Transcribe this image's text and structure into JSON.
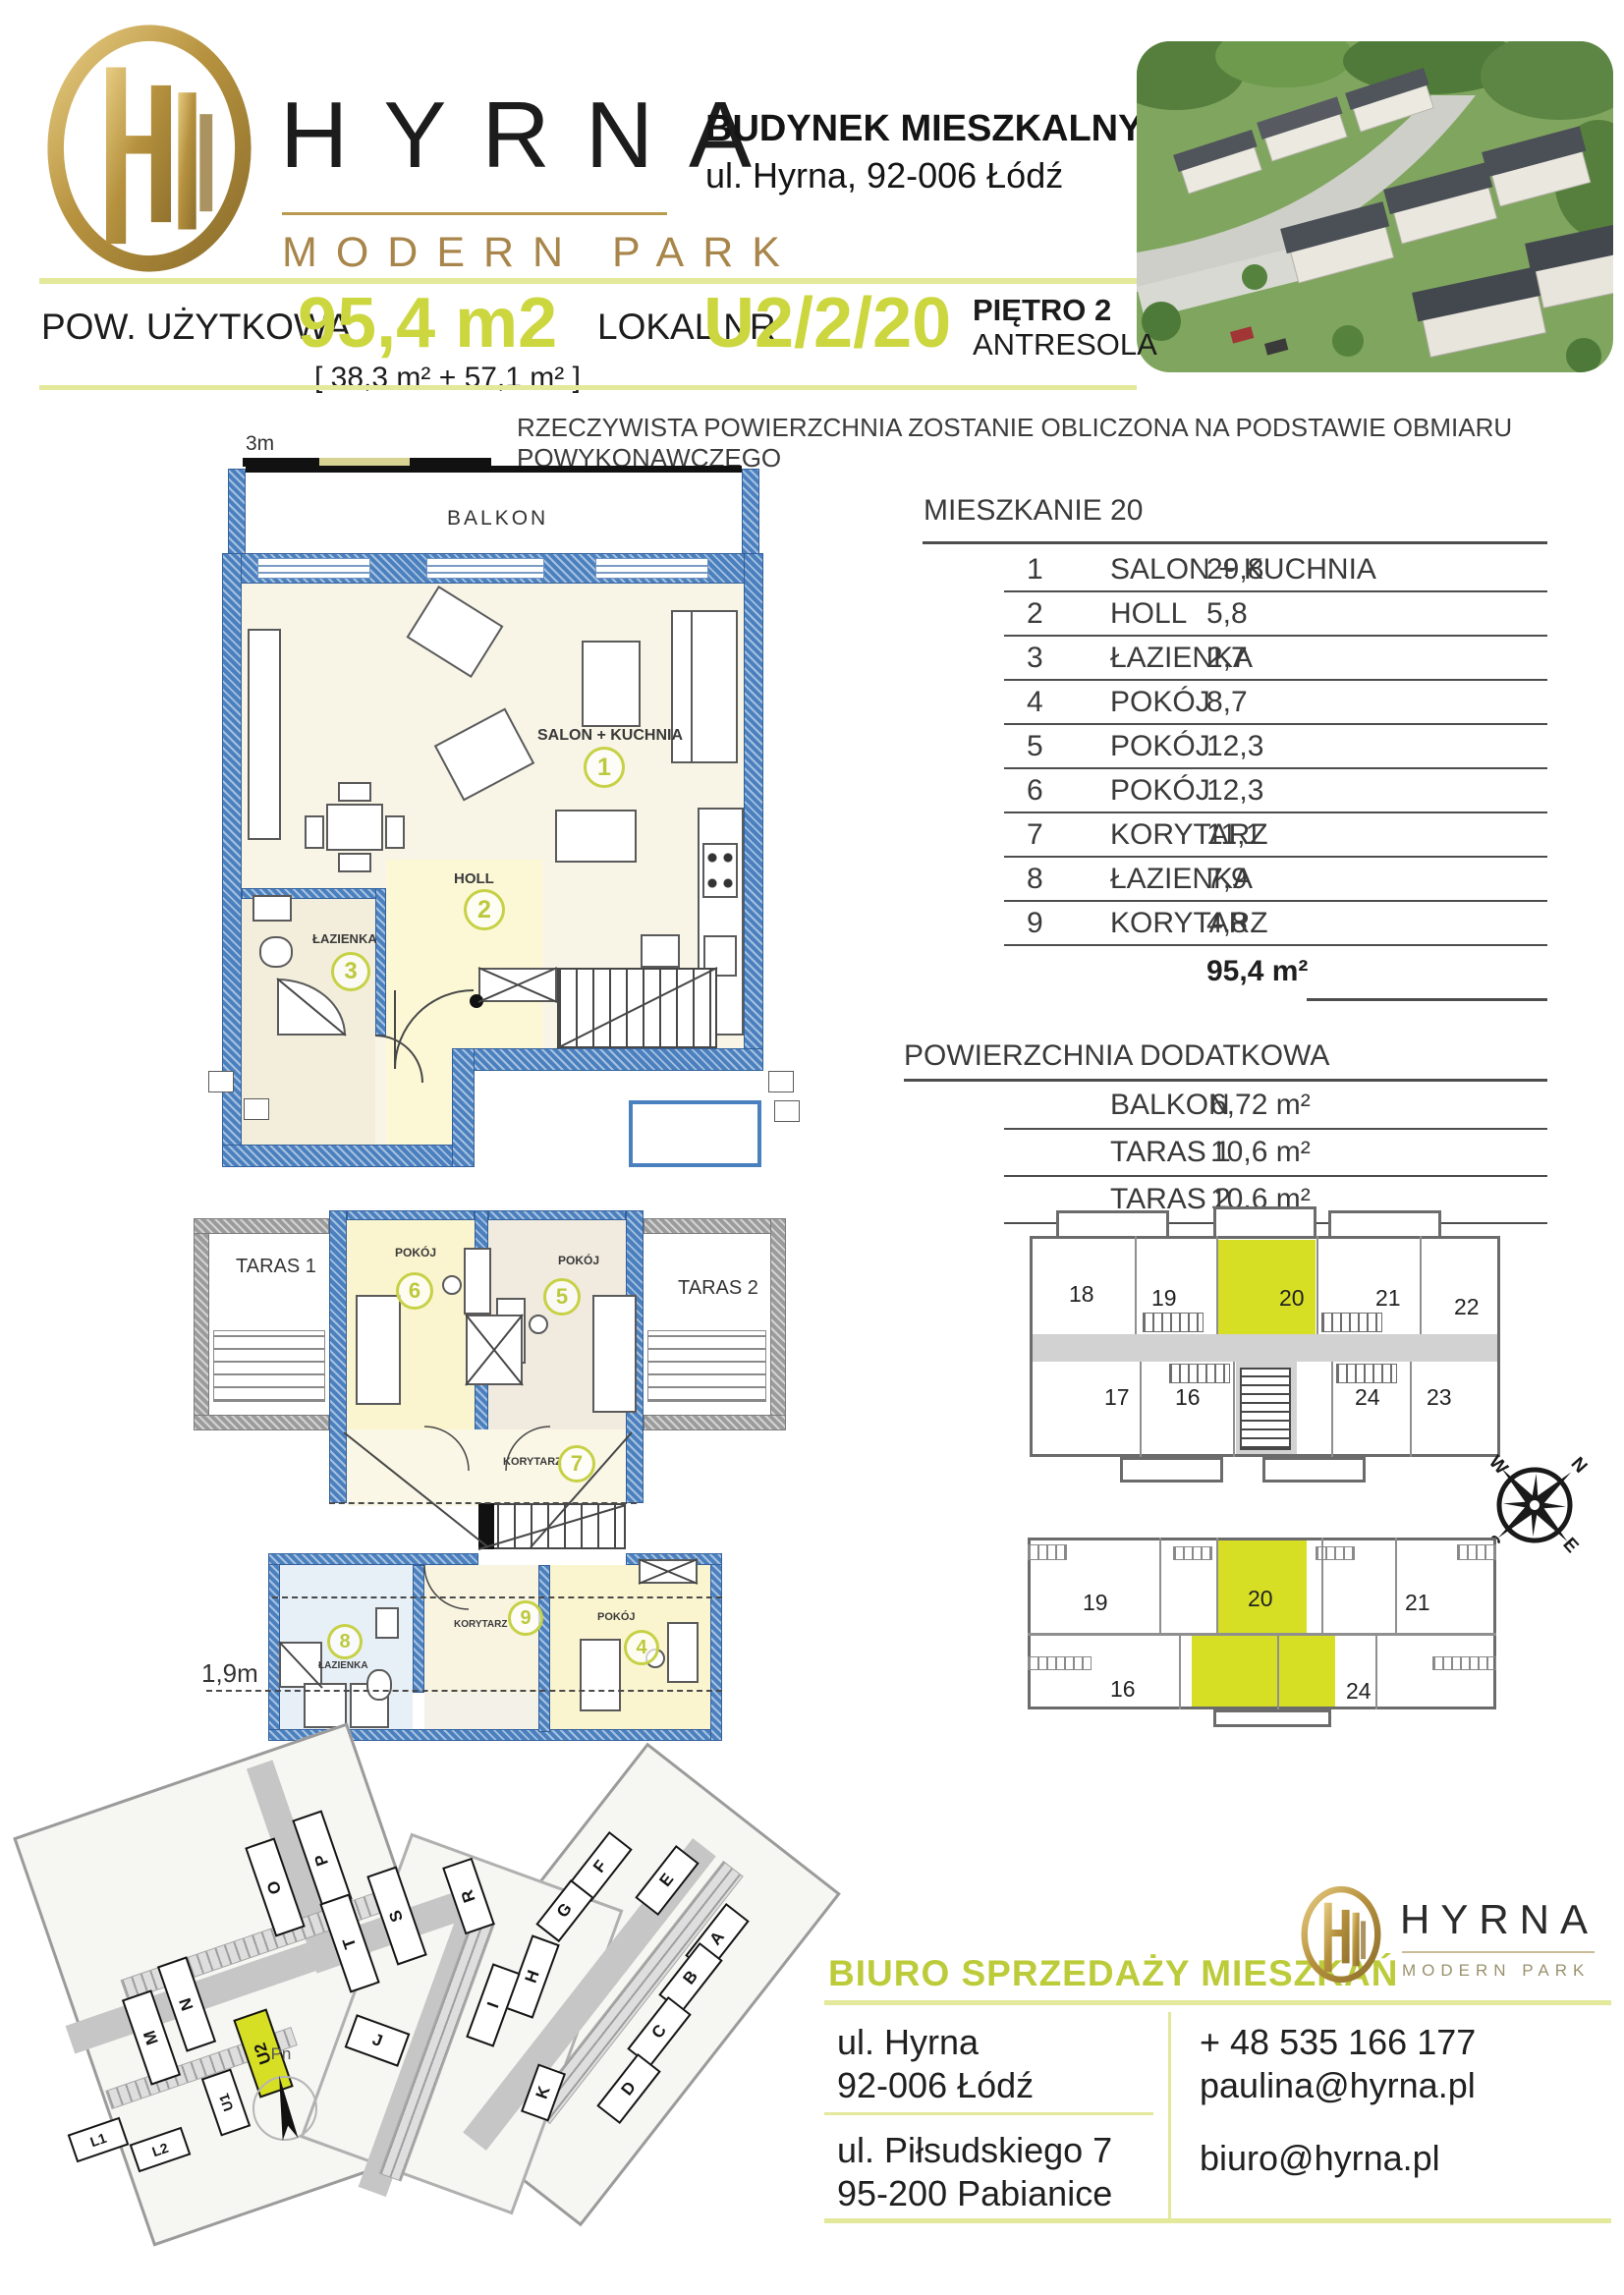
{
  "brand": {
    "name": "HYRNA",
    "tagline": "MODERN PARK"
  },
  "header": {
    "building_title": "BUDYNEK MIESZKALNY U2",
    "building_address": "ul. Hyrna, 92-006 Łódź"
  },
  "info": {
    "area_label": "POW. UŻYTKOWA",
    "area_value": "95,4 m2",
    "area_split": "[ 38,3 m² + 57,1 m² ]",
    "unit_label": "LOKAL NR",
    "unit_value": "U2/2/20",
    "floor_line1": "PIĘTRO 2",
    "floor_line2": "ANTRESOLA"
  },
  "disclaimer": "RZECZYWISTA POWIERZCHNIA ZOSTANIE OBLICZONA NA PODSTAWIE OBMIARU POWYKONAWCZEGO",
  "scalebar": {
    "label": "3m"
  },
  "apt": {
    "title": "MIESZKANIE 20",
    "rows": [
      {
        "no": "1",
        "name": "SALON + KUCHNIA",
        "area": "29,8"
      },
      {
        "no": "2",
        "name": "HOLL",
        "area": "5,8"
      },
      {
        "no": "3",
        "name": "ŁAZIENKA",
        "area": "2,7"
      },
      {
        "no": "4",
        "name": "POKÓJ",
        "area": "8,7"
      },
      {
        "no": "5",
        "name": "POKÓJ",
        "area": "12,3"
      },
      {
        "no": "6",
        "name": "POKÓJ",
        "area": "12,3"
      },
      {
        "no": "7",
        "name": "KORYTARZ",
        "area": "11,1"
      },
      {
        "no": "8",
        "name": "ŁAZIENKA",
        "area": "7,9"
      },
      {
        "no": "9",
        "name": "KORYTARZ",
        "area": "4,8"
      }
    ],
    "total": "95,4 m²"
  },
  "extra": {
    "title": "POWIERZCHNIA DODATKOWA",
    "rows": [
      {
        "name": "BALKON",
        "area": "6,72 m²"
      },
      {
        "name": "TARAS 1",
        "area": "10,6 m²"
      },
      {
        "name": "TARAS 2",
        "area": "10,6 m²"
      }
    ]
  },
  "plan_upper": {
    "balkon": "BALKON",
    "salon": "SALON + KUCHNIA",
    "salon_no": "1",
    "holl": "HOLL",
    "holl_no": "2",
    "lazienka": "ŁAZIENKA",
    "lazienka_no": "3"
  },
  "plan_lower": {
    "taras1": "TARAS 1",
    "taras2": "TARAS 2",
    "pokoj6": "POKÓJ",
    "pokoj6_no": "6",
    "pokoj5": "POKÓJ",
    "pokoj5_no": "5",
    "korytarz7": "KORYTARZ",
    "korytarz7_no": "7",
    "lazienka8": "ŁAZIENKA",
    "lazienka8_no": "8",
    "korytarz9": "KORYTARZ",
    "korytarz9_no": "9",
    "pokoj4": "POKÓJ",
    "pokoj4_no": "4",
    "height_line": "1,9m"
  },
  "overview_floor": {
    "units": [
      "18",
      "19",
      "20",
      "21",
      "22",
      "17",
      "16",
      "24",
      "23"
    ],
    "highlighted": "20"
  },
  "overview_antresola": {
    "units": [
      "19",
      "20",
      "21",
      "16",
      "24"
    ],
    "highlighted": "20"
  },
  "compass": {
    "n": "N",
    "e": "E",
    "s": "S",
    "w": "W"
  },
  "site": {
    "blocks": [
      "P",
      "O",
      "S",
      "T",
      "R",
      "N",
      "M",
      "U1",
      "U2",
      "L1",
      "L2",
      "F",
      "E",
      "G",
      "A",
      "B",
      "C",
      "D",
      "J",
      "H",
      "I",
      "K"
    ],
    "highlighted": "U2",
    "north": "Pn"
  },
  "contact": {
    "title": "BIURO SPRZEDAŻY MIESZKAŃ",
    "addr1_line1": "ul. Hyrna",
    "addr1_line2": "92-006 Łódź",
    "addr2_line1": "ul. Piłsudskiego 7",
    "addr2_line2": "95-200 Pabianice",
    "phone": "+ 48 535 166 177",
    "email1": "paulina@hyrna.pl",
    "email2": "biuro@hyrna.pl"
  },
  "colors": {
    "accent": "#ccd63f",
    "accent_pale": "#e3e89b",
    "highlight": "#d7df25",
    "wall_blue": "#4b80bf",
    "gold": "#b6923f"
  }
}
